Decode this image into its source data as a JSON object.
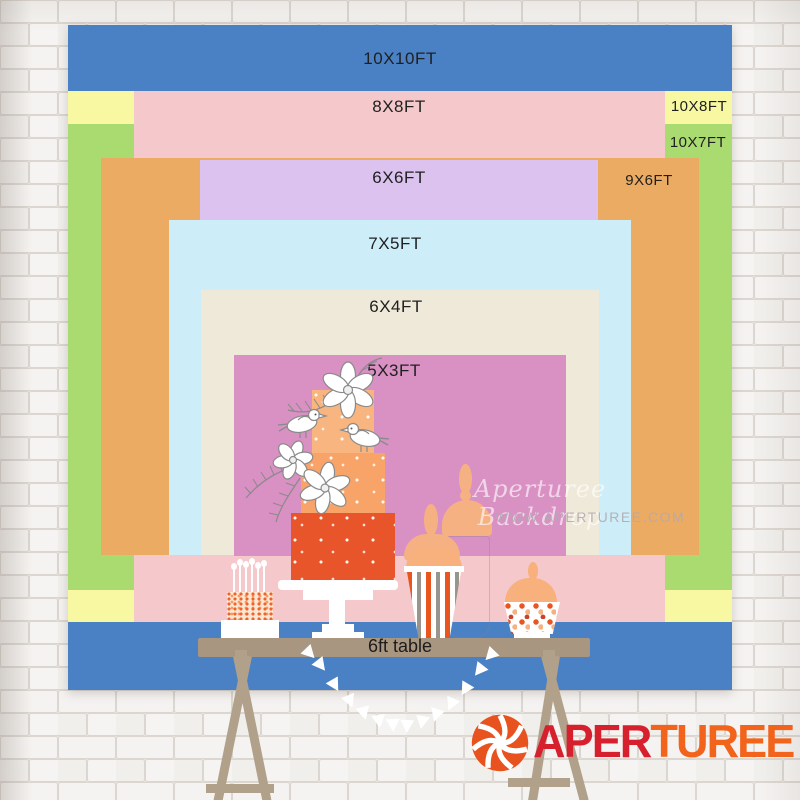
{
  "size_chart": {
    "sizes": [
      {
        "label": "10X10FT",
        "color": "#4a80c4"
      },
      {
        "label": "10X8FT",
        "color": "#f8f8a2"
      },
      {
        "label": "10X7FT",
        "color": "#aadb70"
      },
      {
        "label": "8X8FT",
        "color": "#f5c9cb"
      },
      {
        "label": "9X6FT",
        "color": "#ecab62"
      },
      {
        "label": "6X6FT",
        "color": "#dbc2ef"
      },
      {
        "label": "7X5FT",
        "color": "#cdedf8"
      },
      {
        "label": "6X4FT",
        "color": "#eee9d8"
      },
      {
        "label": "5X3FT",
        "color": "#d990c3"
      }
    ],
    "table_label": "6ft table"
  },
  "watermark": {
    "line1": "Aperturee Backdrop",
    "line2": "WWW.APERTUREE.COM"
  },
  "logo": {
    "text_left": "APER",
    "text_right": "TUREE",
    "left_color": "#d7202d",
    "right_color": "#f2641c",
    "icon_color": "#e8521f"
  },
  "illustration": {
    "cake_top_color": "#f9b57f",
    "cake_mid_color": "#f8a469",
    "cake_bottom_color": "#e9552a",
    "table_color": "#a89680"
  }
}
